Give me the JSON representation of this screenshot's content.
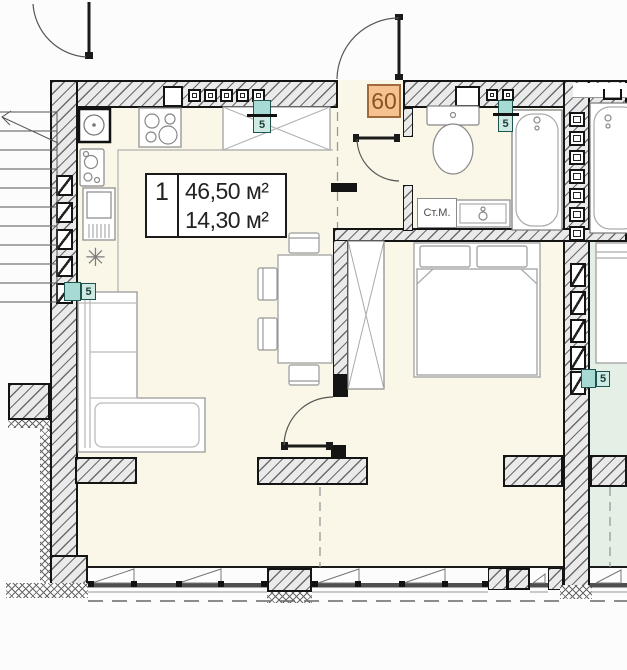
{
  "plan": {
    "unit_badge": "60",
    "area_table": {
      "index": "1",
      "total_area": "46,50 м²",
      "living_area": "14,30 м²"
    },
    "labels": {
      "washing_machine": "Ст.М."
    },
    "markers": {
      "riser": "5"
    },
    "symbols": {
      "fridge": "✳"
    },
    "colors": {
      "floor": "#faf6e8",
      "neighbor_floor": "#e4efe6",
      "wall_fill": "#eaeaea",
      "badge_bg": "#f6c28f",
      "badge_text": "#8a5420",
      "marker_teal": "#a8dad4"
    }
  }
}
